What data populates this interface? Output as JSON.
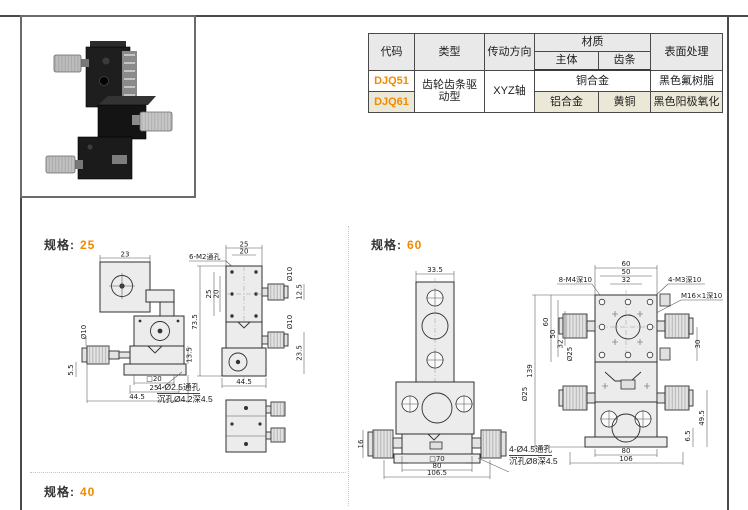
{
  "colors": {
    "accent": "#F08A00"
  },
  "table": {
    "headers": {
      "code": "代码",
      "type": "类型",
      "direction": "传动方向",
      "material": "材质",
      "material_body": "主体",
      "material_rack": "齿条",
      "surface": "表面处理"
    },
    "rows": [
      {
        "code": "DJQ51",
        "type": "齿轮齿条驱动型",
        "direction": "XYZ轴",
        "material": "铜合金",
        "surface": "黑色氟树脂"
      },
      {
        "code": "DJQ61",
        "material_body": "铝合金",
        "material_rack": "黄铜",
        "surface": "黑色阳极氧化"
      }
    ]
  },
  "sections": {
    "spec_label": "规格:",
    "spec25": "25",
    "spec60": "60",
    "spec40": "40"
  },
  "drawings": {
    "spec25_side": {
      "dims": {
        "top_width": "23",
        "knob_dia": "Ø10",
        "stage_height": "13.5",
        "base_step": "5.5",
        "square": "□20",
        "pitch": "25",
        "overall_width": "44.5"
      },
      "note_line1": "4-Ø2.5通孔",
      "note_line2": "沉孔Ø4.2深4.5"
    },
    "spec25_front": {
      "hole_label": "6-M2通孔",
      "dims": {
        "top_outer": "25",
        "top_inner": "20",
        "side_outer": "25",
        "side_inner": "20",
        "overall_height": "73.5",
        "knob_dia_top": "Ø10",
        "knob_offset_top": "12.5",
        "knob_dia_mid": "Ø10",
        "knob_offset_mid": "23.5",
        "overall_width": "44.5"
      }
    },
    "spec60_side": {
      "dims": {
        "top_width": "33.5",
        "knob_height": "16",
        "square": "□70",
        "pitch": "80",
        "overall_width": "106.5"
      },
      "note_line1": "4-Ø4.5通孔",
      "note_line2": "沉孔Ø8深4.5"
    },
    "spec60_front": {
      "hole_label_left": "8-M4深10",
      "hole_label_right": "4-M3深10",
      "center_hole_label": "M16×1深10",
      "dims": {
        "top_outer": "60",
        "top_mid": "50",
        "top_inner": "32",
        "side_outer": "60",
        "side_mid": "50",
        "side_inner": "32",
        "knob_dia_upper": "Ø25",
        "overall_height": "139",
        "right_upper": "30",
        "knob_dia_lower": "Ø25",
        "right_lower": "49.5",
        "base_height": "6.5",
        "bottom_inner": "80",
        "bottom_outer": "106"
      }
    }
  }
}
